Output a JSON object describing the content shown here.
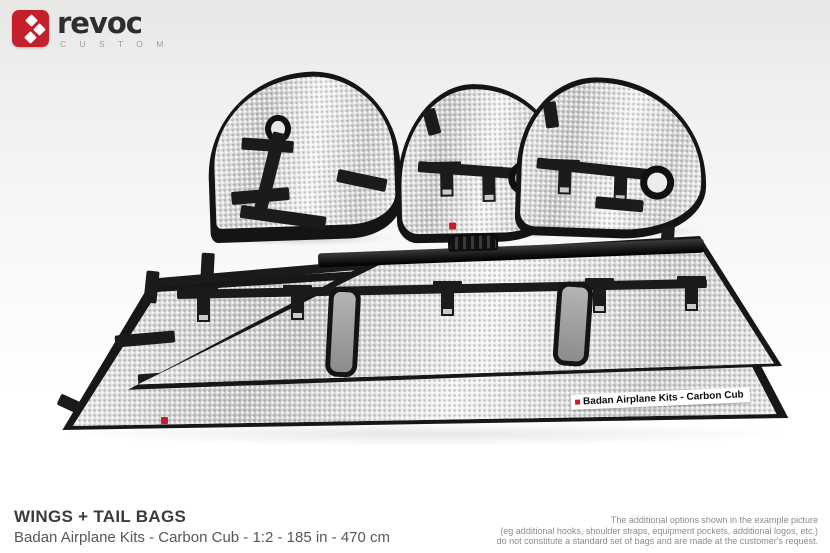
{
  "brand": {
    "name": "revoc",
    "tagline": "C U S T O M",
    "logo_color": "#c4202b"
  },
  "footer": {
    "title": "WINGS + TAIL BAGS",
    "subtitle": "Badan Airplane Kits - Carbon Cub - 1:2 - 185 in - 470 cm",
    "disclaimer_lines": [
      "The additional options shown in the example picture",
      "(eg additional hooks, shoulder straps, equipment pockets, additional logos, etc.)",
      "do not constitute a standard set of bags and are made at the customer's request."
    ]
  },
  "photo": {
    "bag_label": "Badan Airplane Kits - Carbon Cub",
    "items": [
      "vertical-fin-bag",
      "stabilizer-bag-left",
      "stabilizer-bag-right",
      "spar-tube-bag",
      "wing-bag-with-windows",
      "wing-bag-with-label"
    ]
  },
  "colors": {
    "accent_red": "#c4202b",
    "trim_black": "#1b1b1b",
    "foil_silver": "#d7d7d7",
    "window_gray": "#9b9b9b",
    "background": "#ffffff"
  }
}
